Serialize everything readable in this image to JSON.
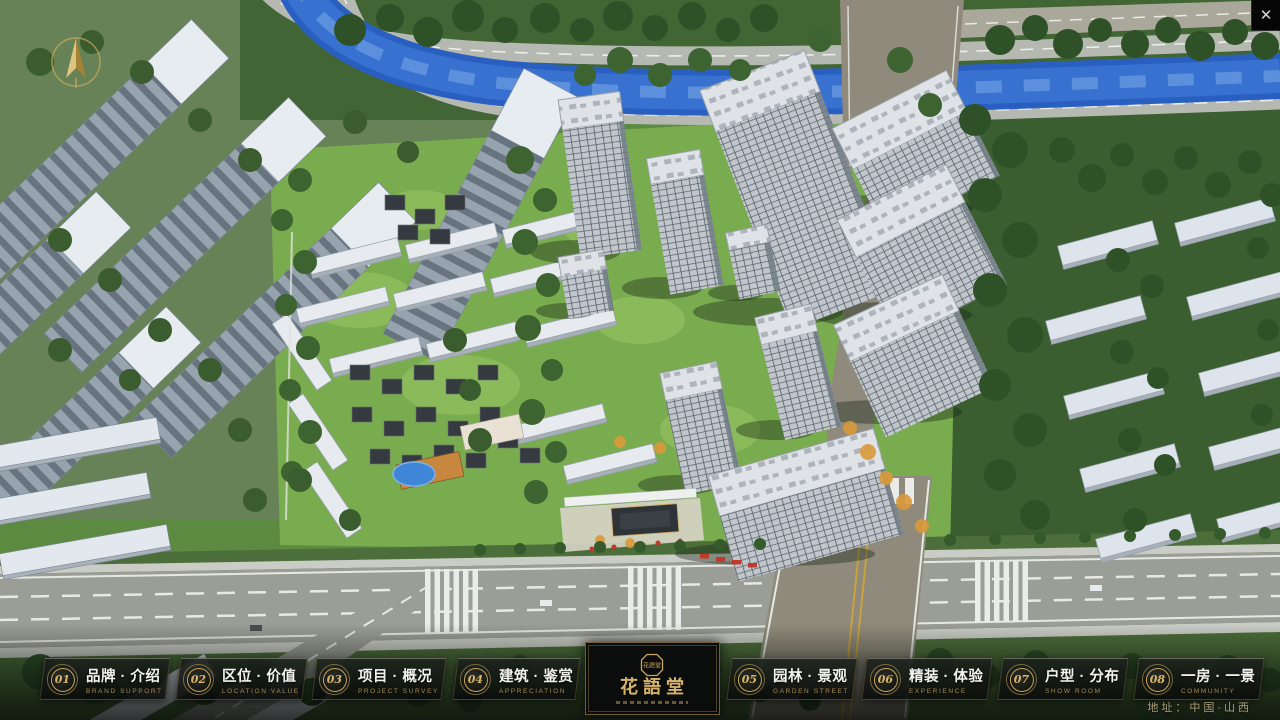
{
  "window": {
    "close_icon": "✕"
  },
  "menu": {
    "items": [
      {
        "num": "01",
        "zh": "品牌 · 介绍",
        "en": "BRAND SUPPORT"
      },
      {
        "num": "02",
        "zh": "区位 · 价值",
        "en": "LOCATION VALUE"
      },
      {
        "num": "03",
        "zh": "项目 · 概况",
        "en": "PROJECT SURVEY"
      },
      {
        "num": "04",
        "zh": "建筑 · 鉴赏",
        "en": "APPRECIATION"
      },
      {
        "num": "05",
        "zh": "园林 · 景观",
        "en": "GARDEN STREET"
      },
      {
        "num": "06",
        "zh": "精装 · 体验",
        "en": "EXPERIENCE"
      },
      {
        "num": "07",
        "zh": "户型 · 分布",
        "en": "SHOW ROOM"
      },
      {
        "num": "08",
        "zh": "一房 · 一景",
        "en": "COMMUNITY"
      }
    ]
  },
  "logo": {
    "title": "花語堂",
    "seal_text": "花語堂"
  },
  "footer": {
    "address": "地址：中国·山西"
  },
  "colors": {
    "gold": "#c9a55e",
    "river": "#2a5fc2",
    "panel_bg": "#101412"
  }
}
